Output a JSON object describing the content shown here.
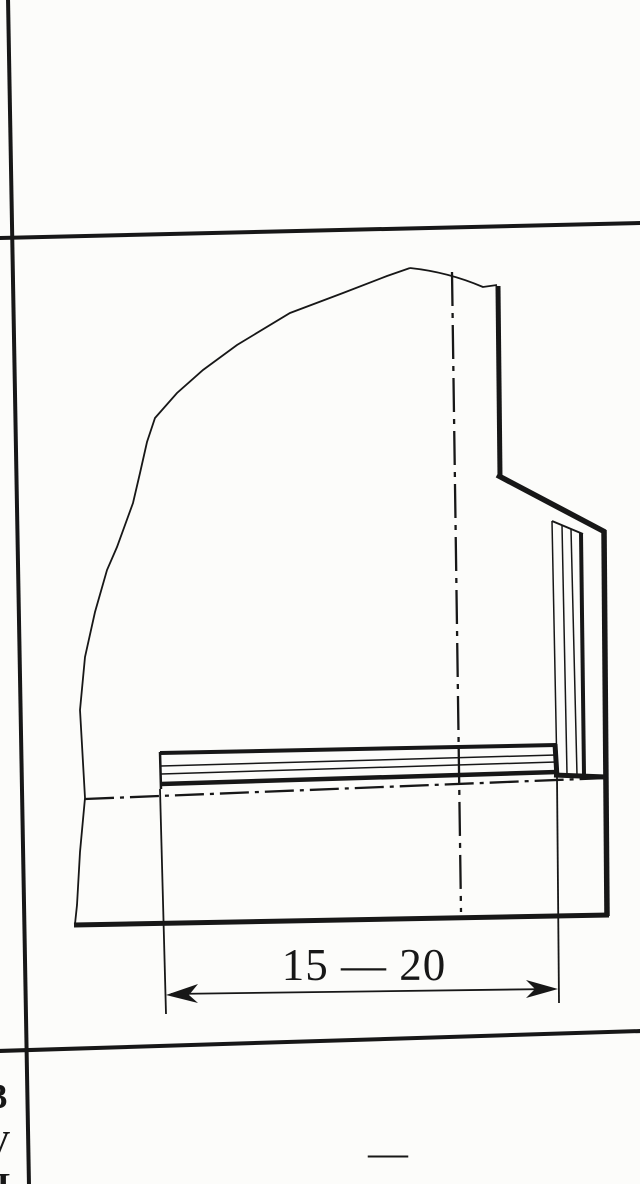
{
  "page": {
    "paper_color": "#fcfcfa",
    "ink_color": "#171717",
    "kind": "scanned technical drawing in a table cell"
  },
  "figure": {
    "dimension": {
      "label": "15 — 20"
    }
  },
  "table": {
    "empty_cell_dash": "—",
    "clipped_glyphs": {
      "g1": "3",
      "g2": "V",
      "g3": "L"
    }
  }
}
